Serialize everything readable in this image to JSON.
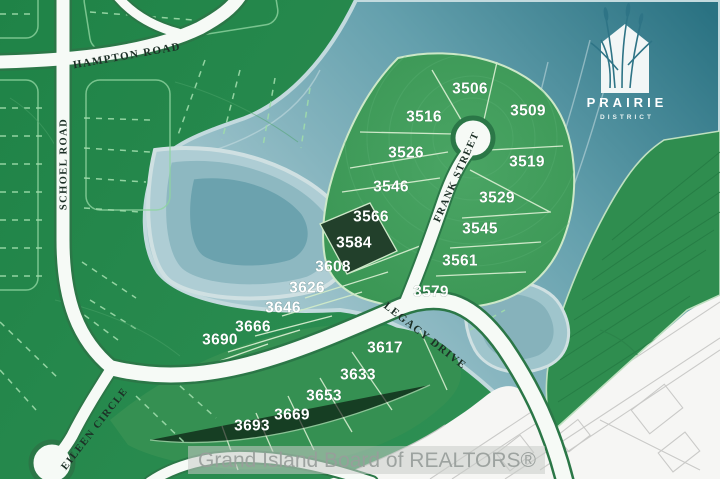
{
  "map": {
    "roads": [
      {
        "name": "HAMPTON ROAD"
      },
      {
        "name": "SCHOEL ROAD"
      },
      {
        "name": "FRANK STREET"
      },
      {
        "name": "LEGACY DRIVE"
      },
      {
        "name": "EILEEN CIRCLE"
      }
    ],
    "lots": [
      {
        "id": "3506"
      },
      {
        "id": "3509"
      },
      {
        "id": "3516"
      },
      {
        "id": "3519"
      },
      {
        "id": "3526"
      },
      {
        "id": "3529"
      },
      {
        "id": "3546"
      },
      {
        "id": "3545"
      },
      {
        "id": "3566"
      },
      {
        "id": "3561"
      },
      {
        "id": "3584",
        "highlighted": true
      },
      {
        "id": "3608"
      },
      {
        "id": "3626"
      },
      {
        "id": "3579"
      },
      {
        "id": "3646"
      },
      {
        "id": "3666"
      },
      {
        "id": "3690"
      },
      {
        "id": "3617"
      },
      {
        "id": "3633"
      },
      {
        "id": "3653"
      },
      {
        "id": "3669"
      },
      {
        "id": "3693"
      }
    ],
    "highlighted_lot": "3584"
  },
  "logo": {
    "line1": "PRAIRIE",
    "line2": "DISTRICT"
  },
  "watermark": {
    "text": "Grand Island Board of REALTORS®"
  },
  "colors": {
    "map_green": "#2e8c4f",
    "lot_green": "#3f9d5e",
    "highlight_lot": "#22402b",
    "water_deep": "#2a7282",
    "water_light": "#a7c9d0",
    "road_white": "#f6faf6",
    "road_casing": "#2b7747",
    "lot_line": "#cde8c8",
    "road_label": "#1c2f26",
    "watermark_gray": "#989e9b",
    "site_plan_gray": "#c6c6c4",
    "logo_teal": "#2e7486"
  }
}
